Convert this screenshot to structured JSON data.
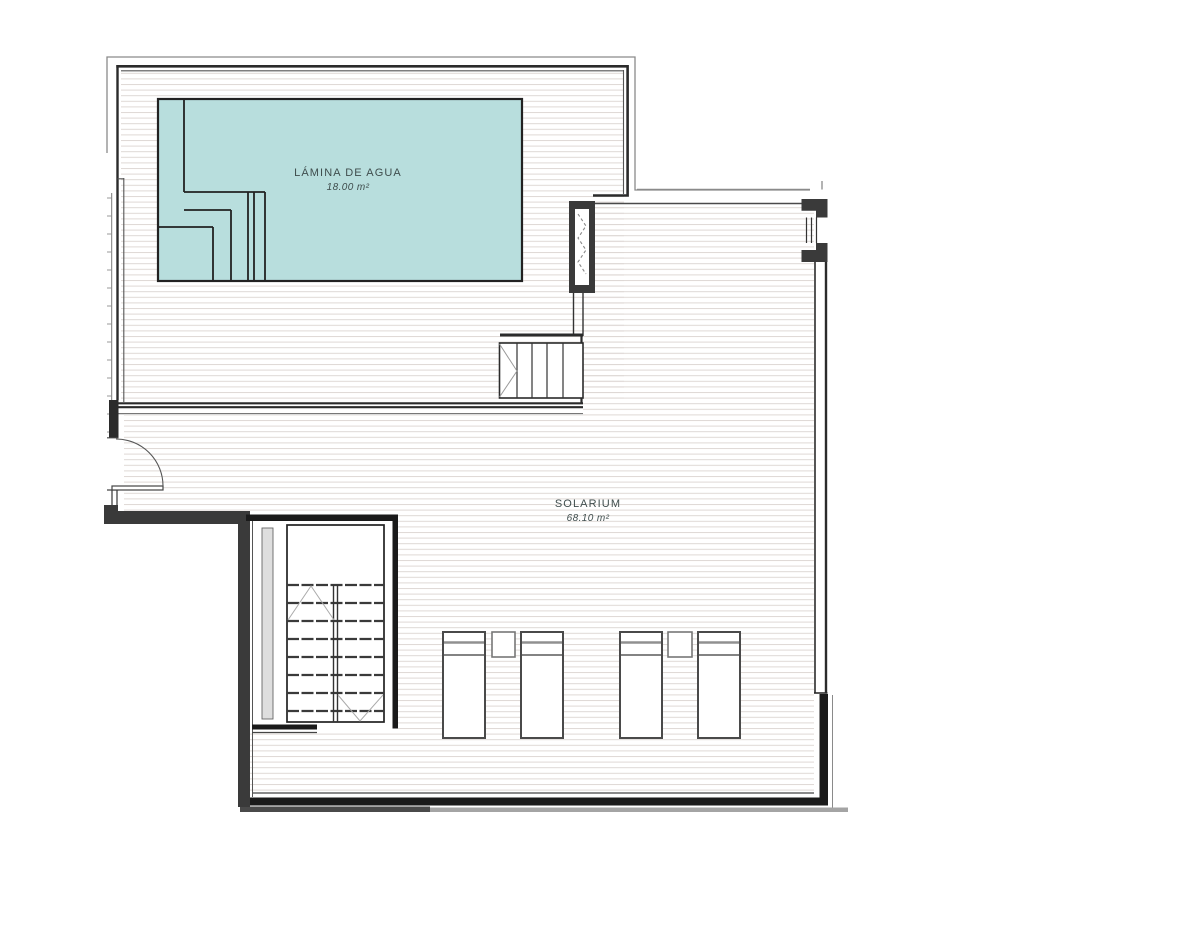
{
  "drawing": {
    "title": "roof terrace floor plan",
    "rooms": [
      {
        "name": "LÁMINA DE AGUA",
        "area": "18.00 m²"
      },
      {
        "name": "SOLARIUM",
        "area": "68.10 m²"
      }
    ]
  },
  "colors": {
    "pool_fill": "#b8dedd",
    "hatch_line": "#ded8d5",
    "wall_dark": "#2b2b2b",
    "wall_black": "#1a1a1a",
    "wall_fill": "#3a3a3a",
    "label_text": "#3f4d4d"
  }
}
